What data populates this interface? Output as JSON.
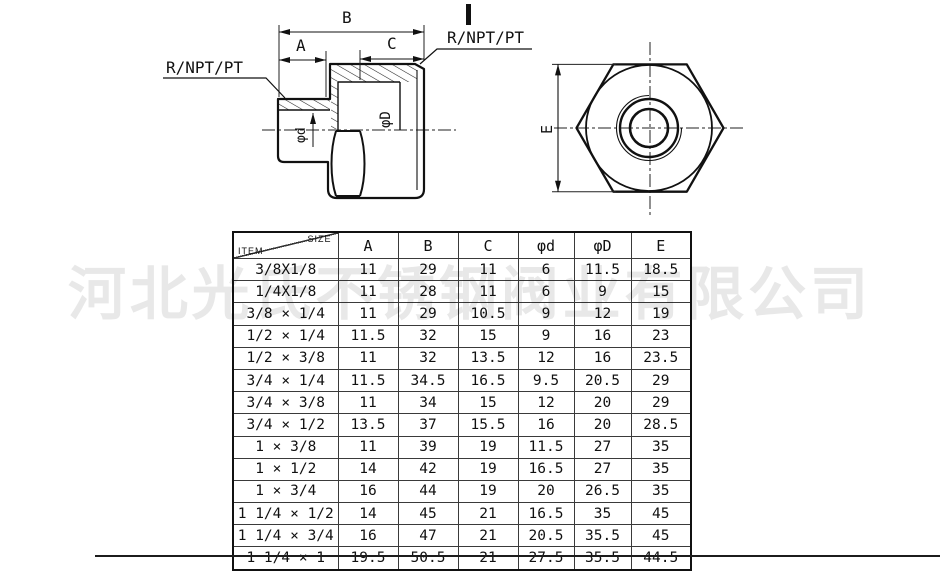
{
  "watermark": {
    "text": "河北光氏不锈钢阀业有限公司",
    "color": "#e8e8e8"
  },
  "drawing": {
    "labels": {
      "thread_left": "R/NPT/PT",
      "thread_right": "R/NPT/PT",
      "dim_a": "A",
      "dim_b": "B",
      "dim_c": "C",
      "dia_small": "φd",
      "dia_large": "φD",
      "dim_e": "E"
    }
  },
  "table": {
    "corner": {
      "top_right": "SIZE",
      "bottom_left": "ITEM"
    },
    "columns": [
      "A",
      "B",
      "C",
      "φd",
      "φD",
      "E"
    ],
    "rows": [
      [
        "3/8X1/8",
        "11",
        "29",
        "11",
        "6",
        "11.5",
        "18.5"
      ],
      [
        "1/4X1/8",
        "11",
        "28",
        "11",
        "6",
        "9",
        "15"
      ],
      [
        "3/8 × 1/4",
        "11",
        "29",
        "10.5",
        "9",
        "12",
        "19"
      ],
      [
        "1/2 × 1/4",
        "11.5",
        "32",
        "15",
        "9",
        "16",
        "23"
      ],
      [
        "1/2 × 3/8",
        "11",
        "32",
        "13.5",
        "12",
        "16",
        "23.5"
      ],
      [
        "3/4 × 1/4",
        "11.5",
        "34.5",
        "16.5",
        "9.5",
        "20.5",
        "29"
      ],
      [
        "3/4 × 3/8",
        "11",
        "34",
        "15",
        "12",
        "20",
        "29"
      ],
      [
        "3/4 × 1/2",
        "13.5",
        "37",
        "15.5",
        "16",
        "20",
        "28.5"
      ],
      [
        "1 × 3/8",
        "11",
        "39",
        "19",
        "11.5",
        "27",
        "35"
      ],
      [
        "1 × 1/2",
        "14",
        "42",
        "19",
        "16.5",
        "27",
        "35"
      ],
      [
        "1 × 3/4",
        "16",
        "44",
        "19",
        "20",
        "26.5",
        "35"
      ],
      [
        "1 1/4 × 1/2",
        "14",
        "45",
        "21",
        "16.5",
        "35",
        "45"
      ],
      [
        "1 1/4 × 3/4",
        "16",
        "47",
        "21",
        "20.5",
        "35.5",
        "45"
      ],
      [
        "1 1/4 × 1",
        "19.5",
        "50.5",
        "21",
        "27.5",
        "35.5",
        "44.5"
      ]
    ]
  }
}
